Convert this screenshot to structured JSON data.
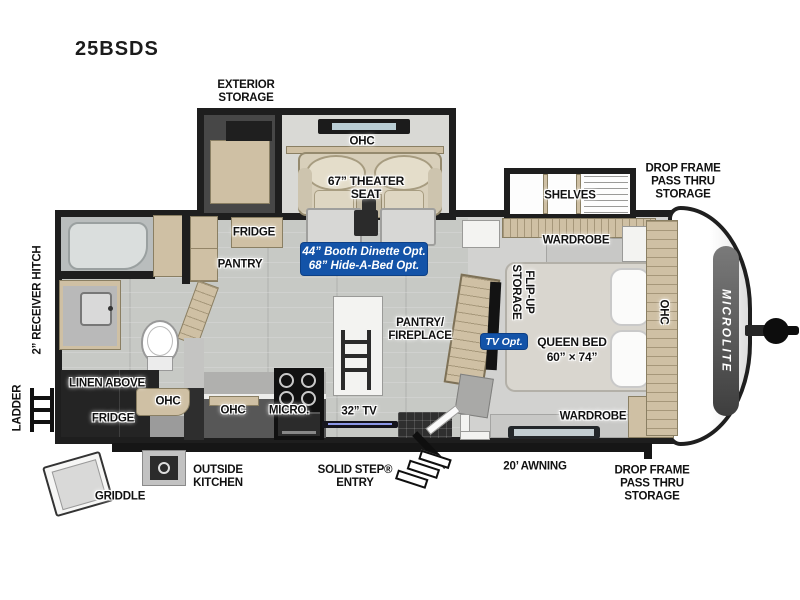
{
  "model": "25BSDS",
  "colors": {
    "badge_blue": "#1353a8",
    "wall": "#1e1e1e",
    "cabinet_wood": "#cfc0a4",
    "floor_living": "#c7c9c5",
    "floor_bedroom": "#d2d2d0",
    "seat_beige": "#d8cfba"
  },
  "exterior": {
    "exterior_storage": [
      "EXTERIOR",
      "STORAGE"
    ],
    "drop_frame_top": [
      "DROP FRAME",
      "PASS THRU",
      "STORAGE"
    ],
    "drop_frame_bottom": [
      "DROP FRAME",
      "PASS THRU",
      "STORAGE"
    ],
    "awning": "20’ AWNING",
    "solid_step": [
      "SOLID STEP®",
      "ENTRY"
    ],
    "outside_kitchen": [
      "OUTSIDE",
      "KITCHEN"
    ],
    "griddle": "GRIDDLE",
    "receiver_hitch": "2” RECEIVER HITCH",
    "ladder": "LADDER",
    "brand": "MICROLITE"
  },
  "living": {
    "ohc_slide": "OHC",
    "theater_seat": [
      "67” THEATER",
      "SEAT"
    ],
    "fridge": "FRIDGE",
    "pantry": "PANTRY",
    "dinette_option": [
      "44” Booth Dinette Opt.",
      "68” Hide-A-Bed Opt."
    ]
  },
  "kitchen": {
    "ohc": "OHC",
    "micro": "MICRO.",
    "tv": "32” TV",
    "pantry_fireplace": [
      "PANTRY/",
      "FIREPLACE"
    ]
  },
  "bath": {
    "linen_above": "LINEN ABOVE",
    "fridge": "FRIDGE",
    "ohc": "OHC"
  },
  "bedroom": {
    "shelves": "SHELVES",
    "wardrobe_top": "WARDROBE",
    "wardrobe_bottom": "WARDROBE",
    "flip_up": [
      "FLIP-UP",
      "STORAGE"
    ],
    "tv_option": "TV Opt.",
    "queen_bed": [
      "QUEEN BED",
      "60” × 74”"
    ],
    "ohc": "OHC"
  }
}
